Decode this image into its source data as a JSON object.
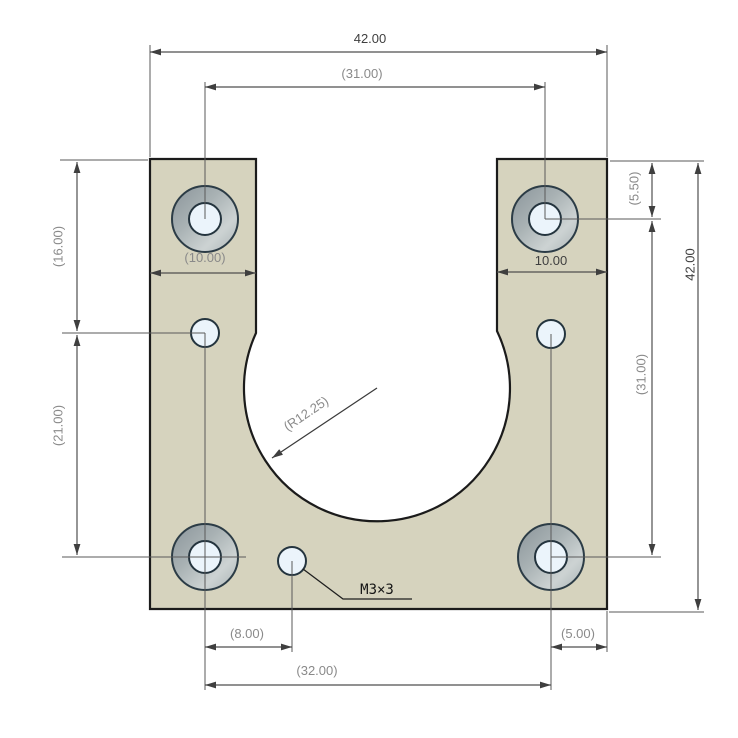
{
  "drawing": {
    "type": "cad-part-drawing",
    "part_name": "motor-mount-plate",
    "colors": {
      "background": "#ffffff",
      "part_fill": "#d6d3be",
      "part_outline": "#1b1b1b",
      "counterbore_dark": "#8a949a",
      "counterbore_mid": "#a9b2b4",
      "counterbore_light": "#cdd3d3",
      "hole_fill": "#ebf4fb",
      "hole_outline": "#24343e",
      "dim_line": "#4f4f4f",
      "dim_text_driven": "#8a8a8a",
      "dim_text_driving": "#3f3f3f",
      "callout_text": "#151515"
    },
    "dimensions": {
      "top_width": "42.00",
      "top_hole_spacing": "(31.00)",
      "left_tab_width": "(10.00)",
      "right_tab_width": "10.00",
      "right_top_hole_offset": "(5.50)",
      "right_height": "42.00",
      "right_hole_spacing": "(31.00)",
      "left_small_hole_offset": "(16.00)",
      "left_lower_spacing": "(21.00)",
      "bottom_m3_offset": "(8.00)",
      "bottom_right_hole_offset": "(5.00)",
      "bottom_hole_spacing": "(32.00)",
      "cutout_radius": "(R12.25)",
      "thread_callout": "M3×3"
    }
  }
}
